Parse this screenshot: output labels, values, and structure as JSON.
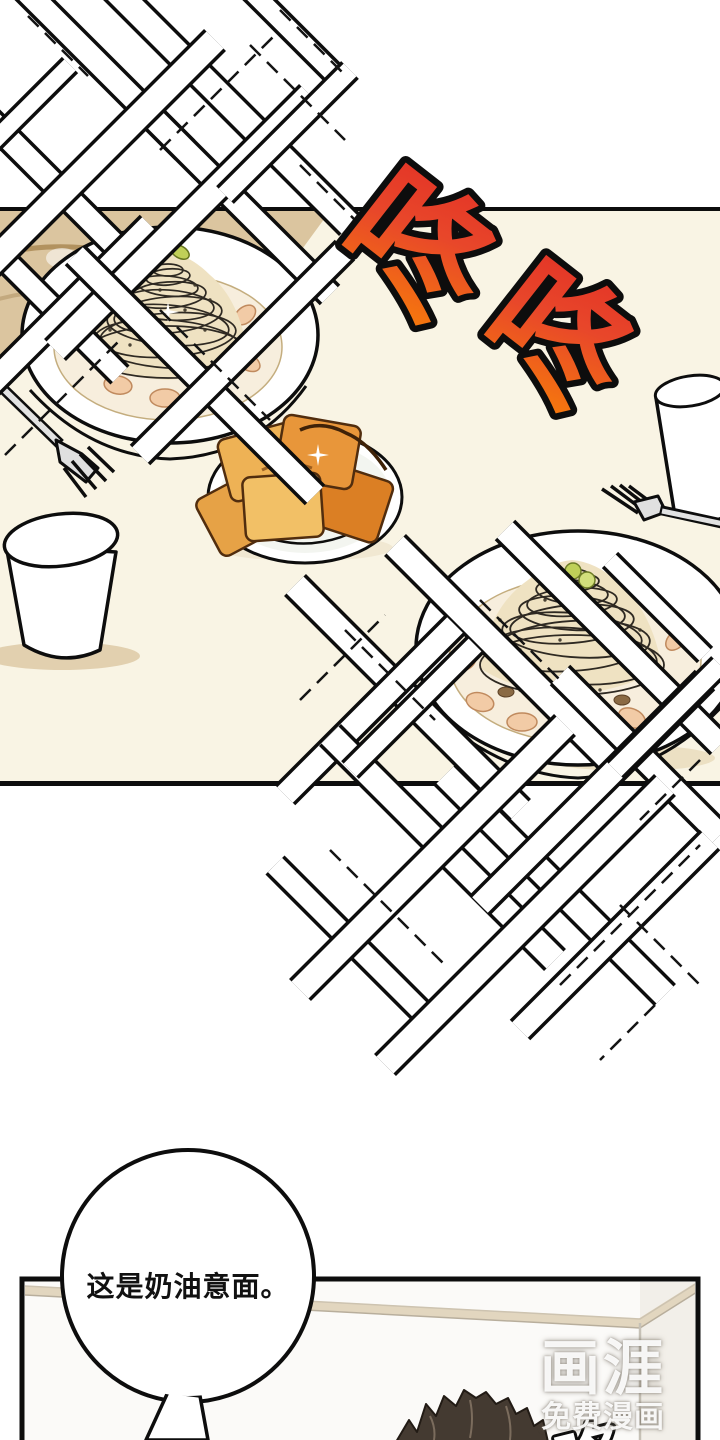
{
  "sfx": {
    "impact_chars": [
      "咚",
      "咚"
    ],
    "muffled_char": "咚"
  },
  "speech": {
    "text": "这是奶油意面。"
  },
  "watermark": {
    "logo": "画涯",
    "tagline": "免费漫画"
  },
  "palette": {
    "sfx_red": "#e33226",
    "sfx_orange": "#f5760e",
    "sfx_outline": "#0d0d0d",
    "table_cream": "#f9f4e4",
    "bench_tan": "#dbc59f",
    "bread_orange": "#e8963a",
    "shrimp_pink": "#f2cba6",
    "garnish_green": "#b5c747",
    "hair_brown": "#443a31",
    "wall_white": "#fbfaf8"
  }
}
